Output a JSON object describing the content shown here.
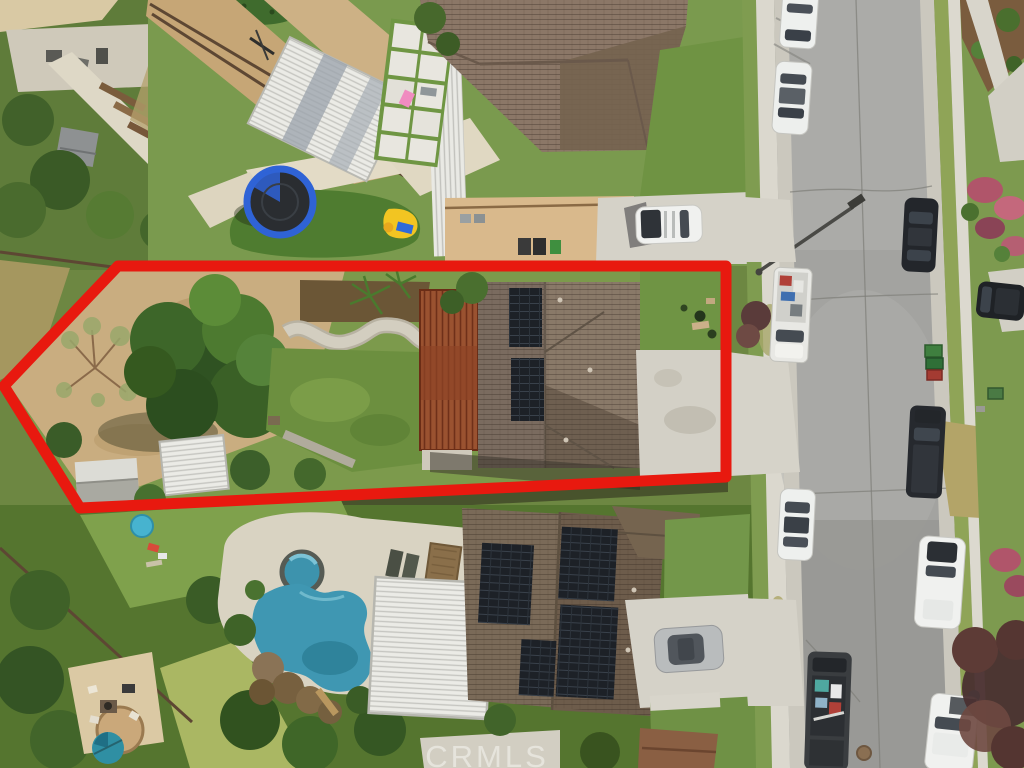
{
  "watermark": {
    "text": "CRMLS"
  },
  "annotation": {
    "type": "property-boundary-outline",
    "color": "#e8190f",
    "stroke_width": 11,
    "points": "118,266 726,266 726,477 80,508 4,386"
  },
  "scene": {
    "type": "aerial-drone-photo",
    "setting": "suburban residential street, top-down view",
    "subject_property": {
      "outlined_in_red": true,
      "features": [
        "two-story house with brown tile roof",
        "two rooftop solar arrays",
        "terracotta lattice patio cover",
        "large green shade tree",
        "bare dirt side yard",
        "sparse dry tree",
        "white storage shed",
        "white slatted canopy",
        "winding concrete path",
        "back lawn",
        "front lawn with shrubs",
        "concrete driveway"
      ]
    },
    "north_neighbor": {
      "features": [
        "tan tile-roof house",
        "white louvered pergola",
        "white paver patio with turf joints",
        "pink pool float",
        "blue trampoline",
        "yellow-blue kids slide",
        "putting green",
        "dirt hillside with fences",
        "concrete driveway",
        "white SUV in driveway",
        "trash bins"
      ]
    },
    "south_neighbor": {
      "features": [
        "house with large rooftop solar arrays",
        "white louvered pergola",
        "free-form swimming pool",
        "round spa",
        "rock waterfall with slide",
        "lounge chairs",
        "brown deck mat",
        "silver car in driveway",
        "fire-pit patio",
        "round teal hot tub",
        "blue kiddie pool"
      ]
    },
    "west_neighbor": {
      "features": [
        "tan building corner",
        "concrete patio with furniture",
        "terraced garden path",
        "gray shed",
        "small blue pool",
        "dense trees"
      ]
    },
    "street": {
      "surface": "gray asphalt with cracks and concrete gutters",
      "fixtures": [
        "streetlight",
        "manhole cover",
        "green utility box",
        "two green trash bins",
        "one red trash bin"
      ],
      "vehicles": [
        {
          "name": "white car",
          "side": "west",
          "color": "#eef0ee"
        },
        {
          "name": "white sedan",
          "side": "west",
          "color": "#eef0ee"
        },
        {
          "name": "black sedan",
          "side": "east",
          "color": "#23262b"
        },
        {
          "name": "white pickup with cargo",
          "side": "west",
          "color": "#e8e8e4"
        },
        {
          "name": "black SUV in driveway",
          "side": "east",
          "color": "#1f2226"
        },
        {
          "name": "black pickup",
          "side": "east",
          "color": "#26292e"
        },
        {
          "name": "white car",
          "side": "west",
          "color": "#eef0ee"
        },
        {
          "name": "white SUV",
          "side": "east",
          "color": "#f0f1ef"
        },
        {
          "name": "dark truck with colorful cargo",
          "side": "west",
          "color": "#3a3d40"
        },
        {
          "name": "white truck",
          "side": "east",
          "color": "#f0f1ef"
        }
      ]
    },
    "east_side": {
      "features": [
        "sidewalk",
        "grass parkway",
        "pink flowering shrubs",
        "mulch corner bed",
        "dark-leaved tree",
        "driveways"
      ]
    }
  }
}
